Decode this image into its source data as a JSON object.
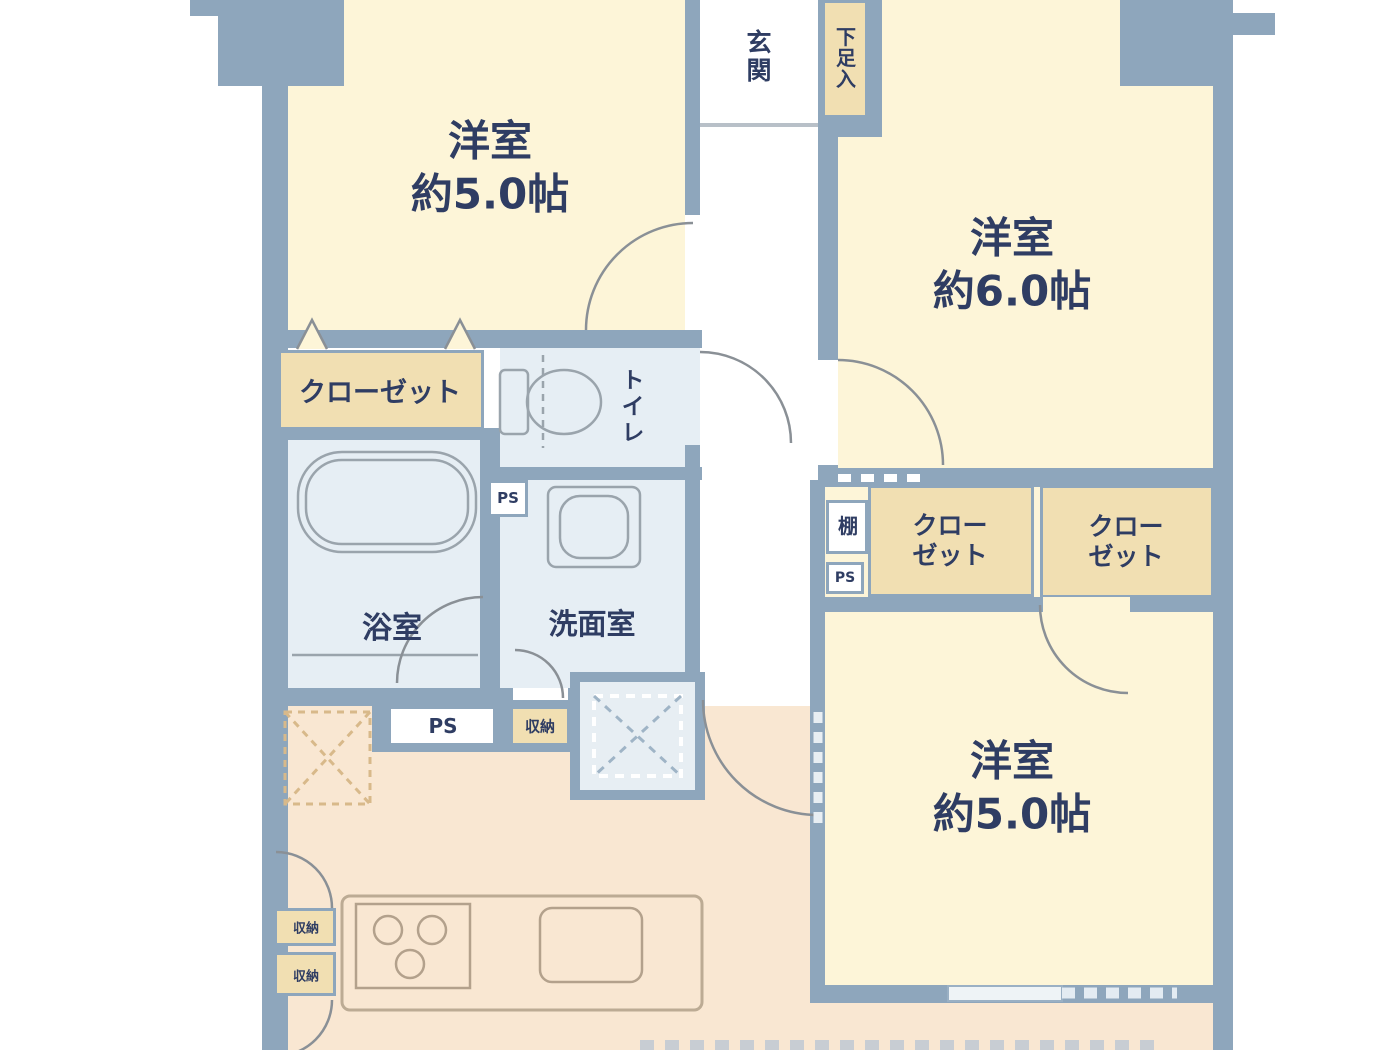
{
  "plan": {
    "rooms": {
      "western_tl": {
        "name": "洋室",
        "size": "約5.0帖"
      },
      "western_tr": {
        "name": "洋室",
        "size": "約6.0帖"
      },
      "western_br": {
        "name": "洋室",
        "size": "約5.0帖"
      },
      "bath": "浴室",
      "washroom": "洗面室",
      "toilet": "トイレ",
      "entrance": "玄関",
      "shoe_storage": "下足入"
    },
    "fixtures": {
      "closet": "クローゼット",
      "closet_line1": "クロー",
      "closet_line2": "ゼット",
      "shelf": "棚",
      "pipe_space": "PS",
      "storage": "収納"
    },
    "colors": {
      "wall": "#8ea6bc",
      "room_fill": "#fdf5d8",
      "ldk_fill": "#f9e7d2",
      "wet_area_fill": "#e6eef4",
      "closet_fill": "#f1dfb2",
      "label_text": "#2f3d63"
    }
  }
}
